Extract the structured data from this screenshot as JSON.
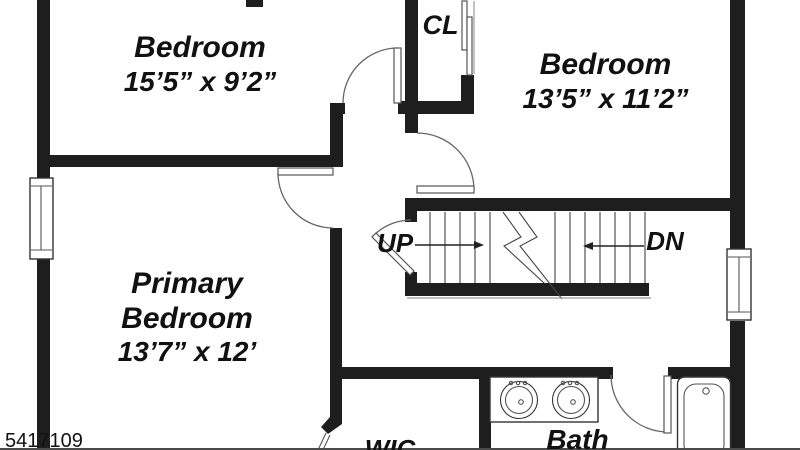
{
  "plan": {
    "rooms": {
      "bedroom_top_left": {
        "name": "Bedroom",
        "dims": "15’5” x 9’2”"
      },
      "bedroom_top_right": {
        "name": "Bedroom",
        "dims": "13’5” x 11’2”"
      },
      "primary_bedroom": {
        "name_line1": "Primary",
        "name_line2": "Bedroom",
        "dims": "13’7” x 12’"
      },
      "closet": {
        "label": "CL"
      },
      "walk_in_closet": {
        "label": "WIC"
      },
      "bath": {
        "label": "Bath"
      }
    },
    "stairs": {
      "up_label": "UP",
      "down_label": "DN"
    },
    "watermark": "5417109",
    "colors": {
      "wall": "#1e1e1e",
      "line": "#555555",
      "text": "#111111",
      "background": "#ffffff"
    }
  }
}
